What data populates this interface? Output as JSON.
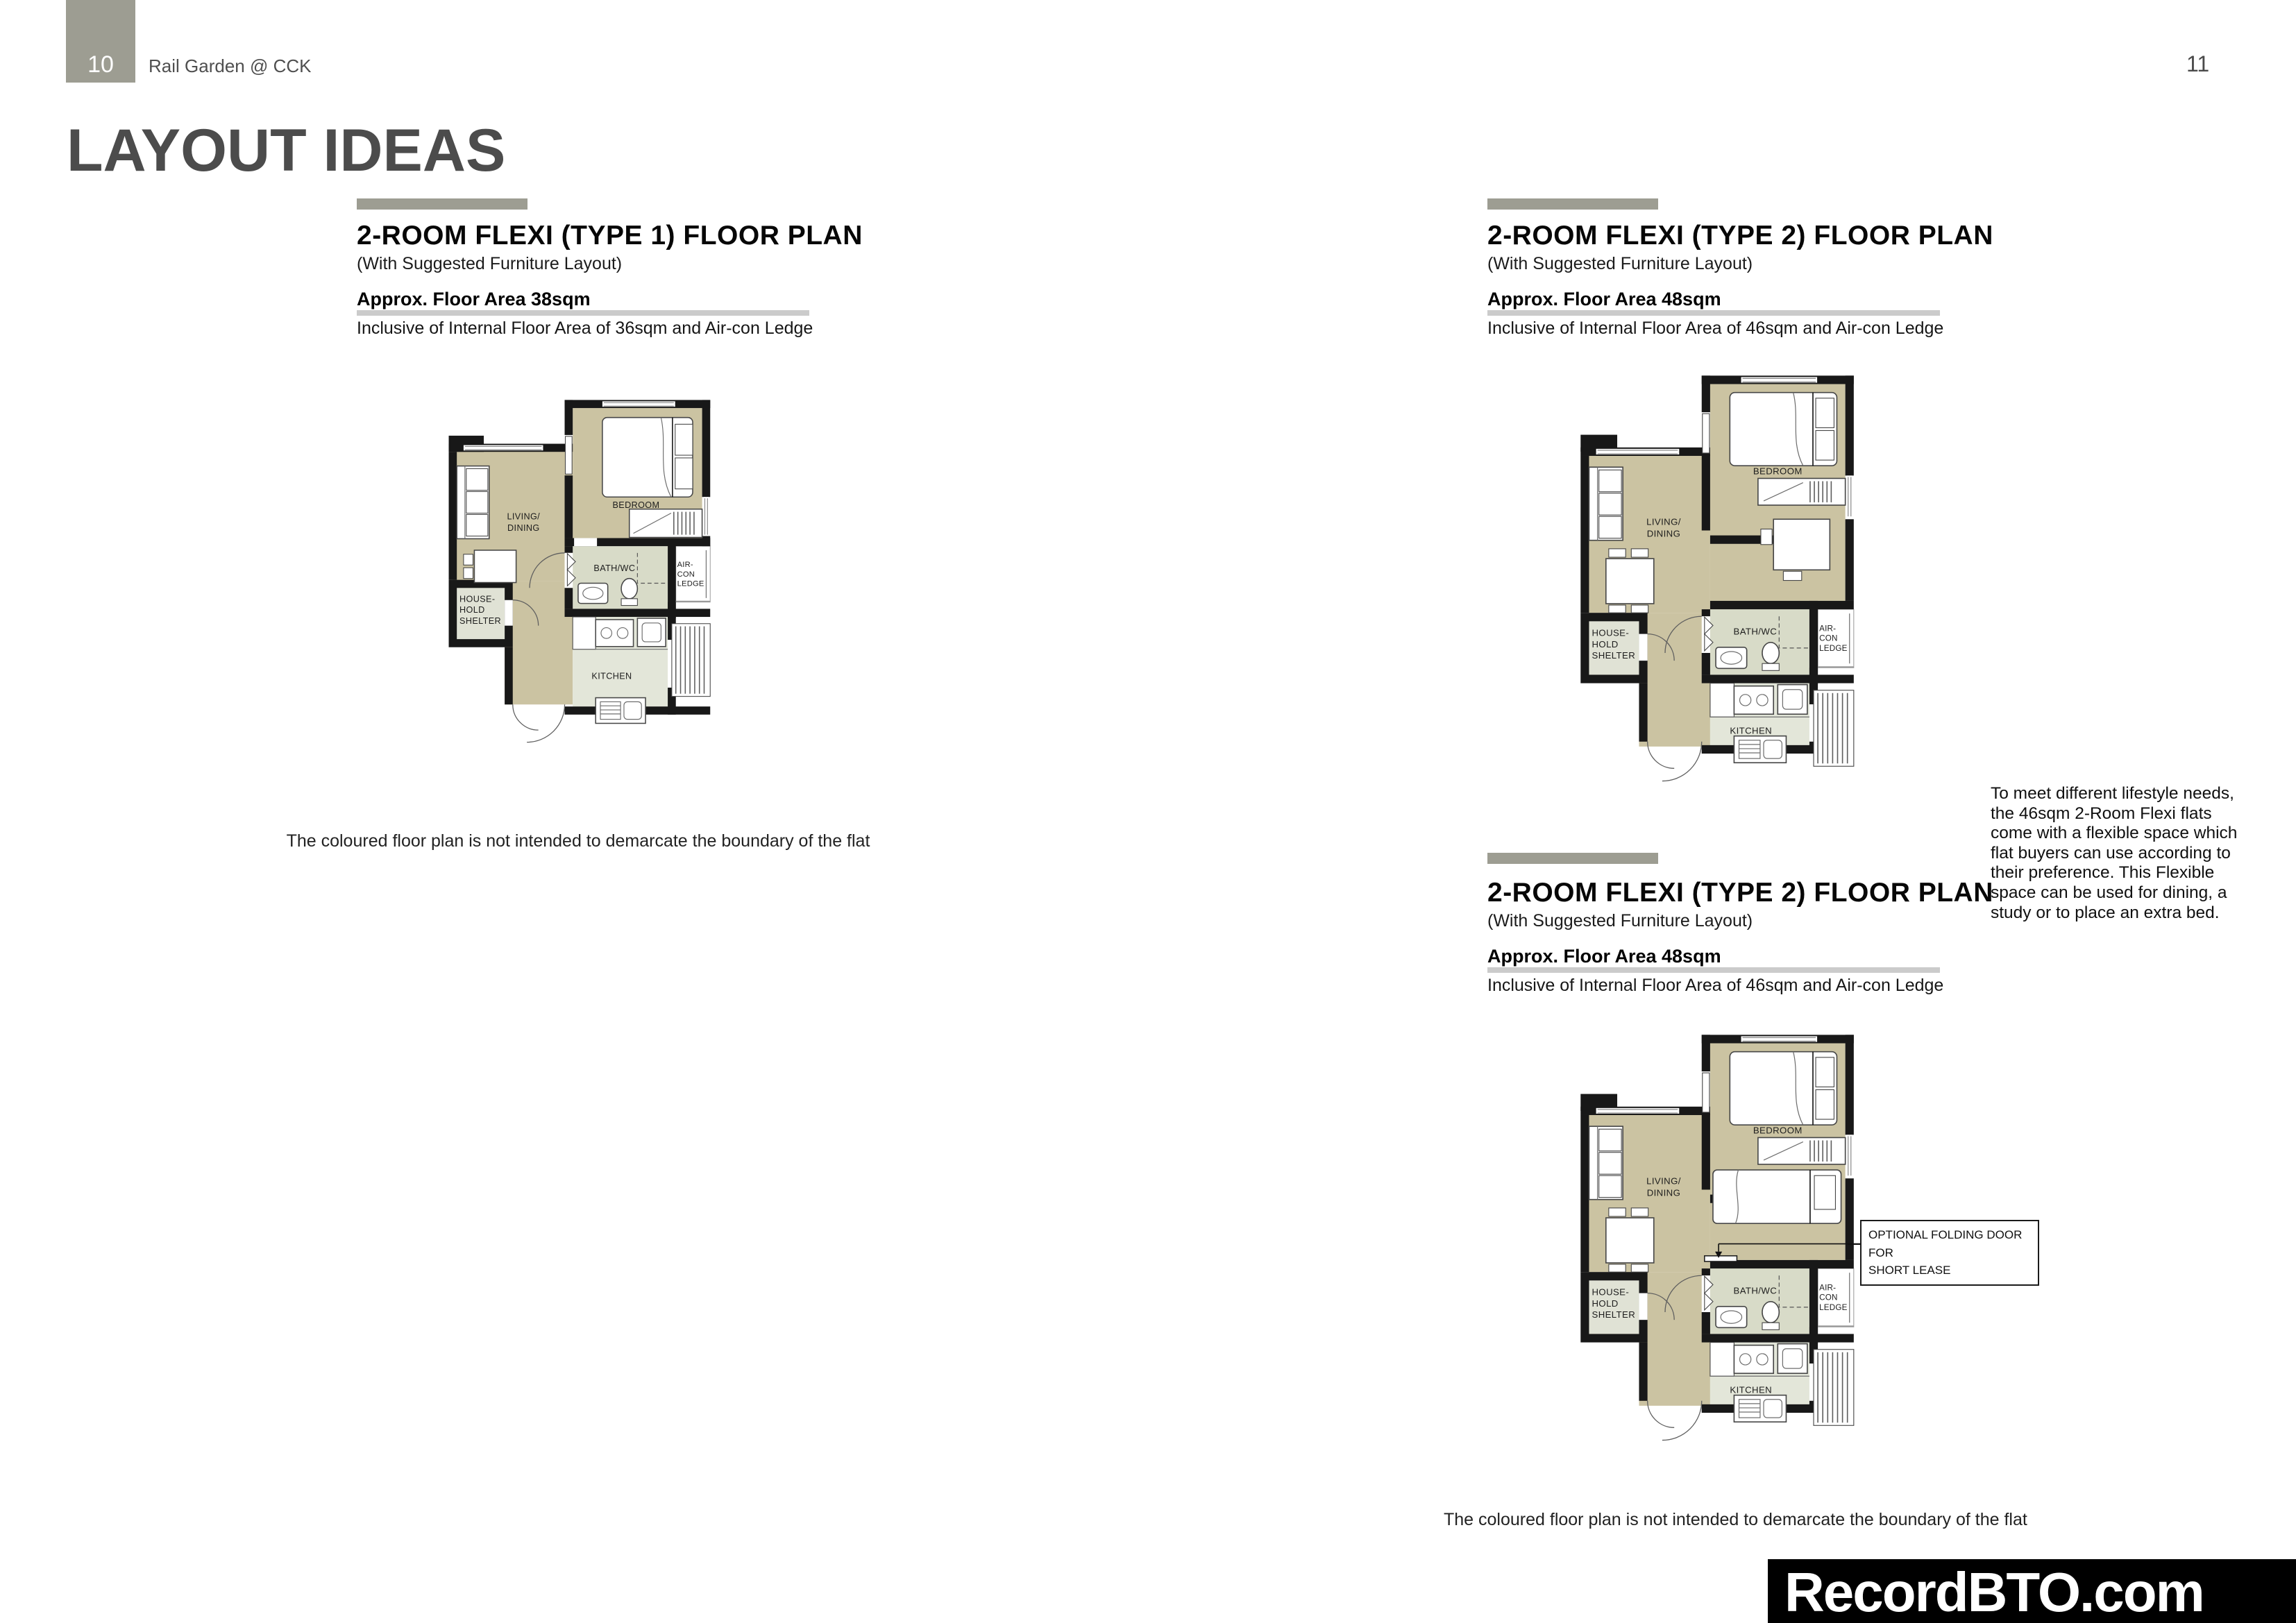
{
  "header": {
    "left_page_number": "10",
    "project_name": "Rail Garden @ CCK",
    "right_page_number": "11",
    "title": "LAYOUT IDEAS"
  },
  "sections": [
    {
      "heading": "2-ROOM FLEXI (TYPE 1) FLOOR PLAN",
      "subheading": "(With Suggested Furniture Layout)",
      "area": "Approx. Floor Area 38sqm",
      "area_note": "Inclusive of Internal Floor Area of 36sqm and Air-con Ledge"
    },
    {
      "heading": "2-ROOM FLEXI (TYPE 2) FLOOR PLAN",
      "subheading": "(With Suggested Furniture Layout)",
      "area": "Approx. Floor Area 48sqm",
      "area_note": "Inclusive of Internal Floor Area of 46sqm and Air-con Ledge"
    },
    {
      "heading": "2-ROOM FLEXI (TYPE 2) FLOOR PLAN",
      "subheading": "(With Suggested Furniture Layout)",
      "area": "Approx. Floor Area 48sqm",
      "area_note": "Inclusive of Internal Floor Area of 46sqm and Air-con Ledge"
    }
  ],
  "room_labels": {
    "living": [
      "LIVING/",
      "DINING"
    ],
    "bedroom": "BEDROOM",
    "bath": "BATH/WC",
    "kitchen": "KITCHEN",
    "household": [
      "HOUSE-",
      "HOLD",
      "SHELTER"
    ],
    "aircon": [
      "AIR-",
      "CON",
      "LEDGE"
    ]
  },
  "lifestyle_note": {
    "lines": [
      "To meet different lifestyle needs,",
      "the 46sqm 2-Room Flexi flats",
      "come with a flexible space which",
      "flat buyers can use according to",
      "their preference. This Flexible",
      "space can be used for dining, a",
      "study or to place an extra bed."
    ]
  },
  "callout": {
    "lines": [
      "OPTIONAL FOLDING DOOR FOR",
      "SHORT LEASE"
    ]
  },
  "captions": {
    "left": "The coloured floor plan is not intended to demarcate the boundary of the flat",
    "right": "The coloured floor plan is not intended to demarcate the boundary of the flat"
  },
  "watermark": "RecordBTO.com",
  "colors": {
    "accent_gray": "#9d9d92",
    "title_gray": "#4c4c4c",
    "floor_tan": "#cbc3a2",
    "floor_bath": "#d8dbc8",
    "floor_kitchen": "#e3e6d9",
    "wall_black": "#181818",
    "underline_gray": "#cbcbcb",
    "watermark_bg": "#000000"
  }
}
